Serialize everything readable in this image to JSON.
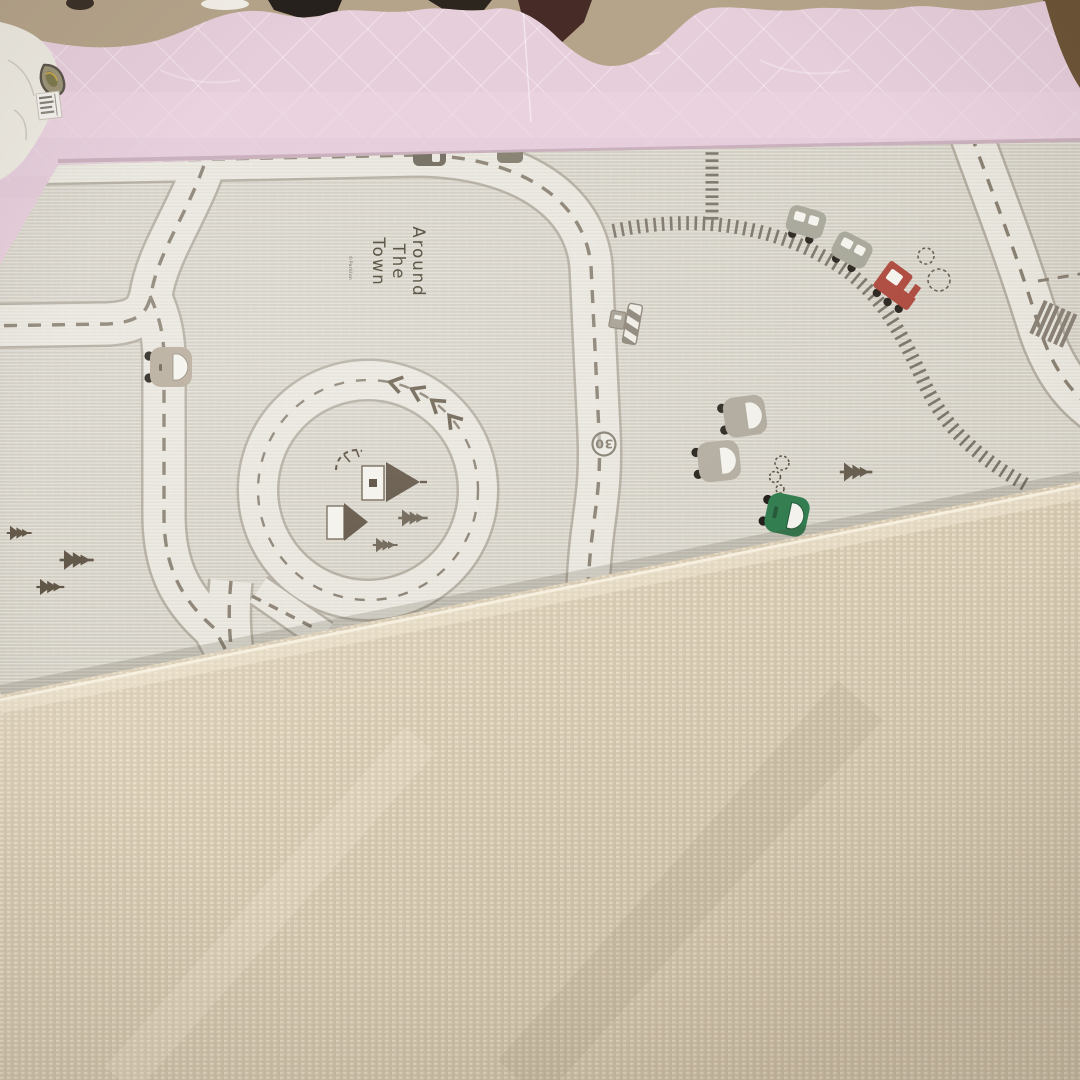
{
  "scene": {
    "setting": "photo of a foldable baby play mat lying on a bed",
    "visible_objects": [
      "pink quilted bedspread",
      "white crinkled sheet",
      "fabric care tag",
      "play mat printed with a toy town road map",
      "folded-over mat corner showing plain linen backing"
    ]
  },
  "mat": {
    "title_line1": "Around",
    "title_line2": "The",
    "title_line3": "Town",
    "credit": "©Parklon",
    "road_marking_30": "30"
  },
  "colors": {
    "quilt_pink": "#e6cedb",
    "mat_base": "#d3cfc5",
    "road_white": "#f2f0e9",
    "road_border": "#9a9284",
    "road_dash": "#8a8173",
    "railroad": "#7c756a",
    "train_red": "#ae4b3f",
    "car_green": "#2d7a4b",
    "car_tan": "#b6aa99",
    "artwork_brown": "#5a4f3f",
    "backing_linen": "#d5c7af",
    "background_tan": "#b5a48a"
  }
}
